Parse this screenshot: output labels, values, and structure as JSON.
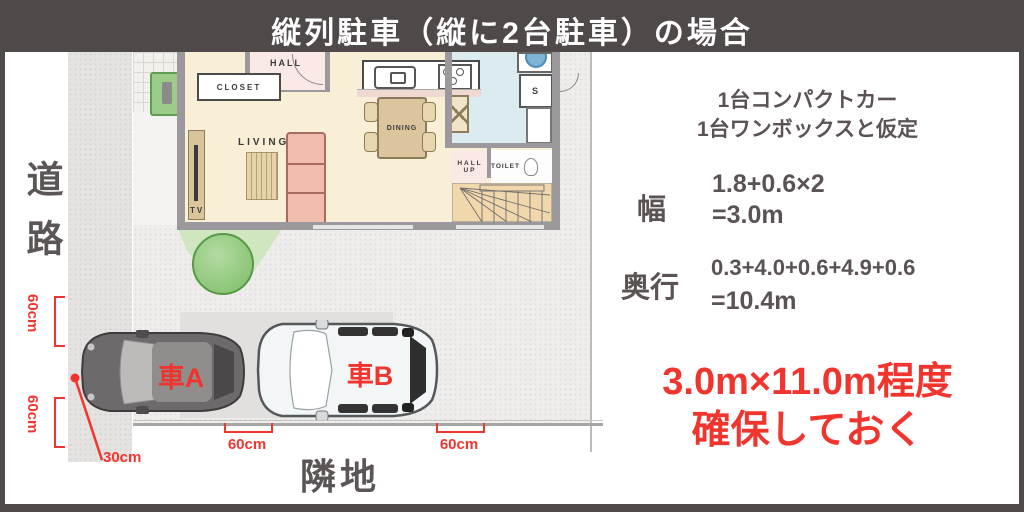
{
  "title": "縦列駐車（縦に2台駐車）の場合",
  "colors": {
    "frame": "#4f4a49",
    "accent_red": "#f0352f",
    "text_dark": "#5b5353",
    "floor_cream": "#f9eed6",
    "floor_kitchen_blue": "#dcebf0",
    "room_pink": "#fbe9e5",
    "wall_gray": "#9b999b",
    "tree_green": "#7cbd68"
  },
  "site_plan": {
    "road_label": "道路",
    "neighbor_label": "隣地",
    "rooms": {
      "closet": "CLOSET",
      "hall": "HALL",
      "living": "LIVING",
      "tv": "TV",
      "dining": "DINING",
      "storage": "S",
      "hall2": "HALL",
      "up": "UP",
      "toilet": "TOILET"
    },
    "cars": {
      "car_a": "車A",
      "car_b": "車B"
    },
    "measurements": {
      "left_top": "60cm",
      "left_bottom": "60cm",
      "front_offset": "30cm",
      "gap_between_cars": "60cm",
      "gap_behind": "60cm"
    }
  },
  "panel": {
    "assumption_line1": "1台コンパクトカー",
    "assumption_line2": "1台ワンボックスと仮定",
    "width_label": "幅",
    "width_formula": "1.8+0.6×2",
    "width_result": "=3.0m",
    "depth_label": "奥行",
    "depth_formula": "0.3+4.0+0.6+4.9+0.6",
    "depth_result": "=10.4m",
    "conclusion_line1": "3.0m×11.0m程度",
    "conclusion_line2": "確保しておく"
  }
}
